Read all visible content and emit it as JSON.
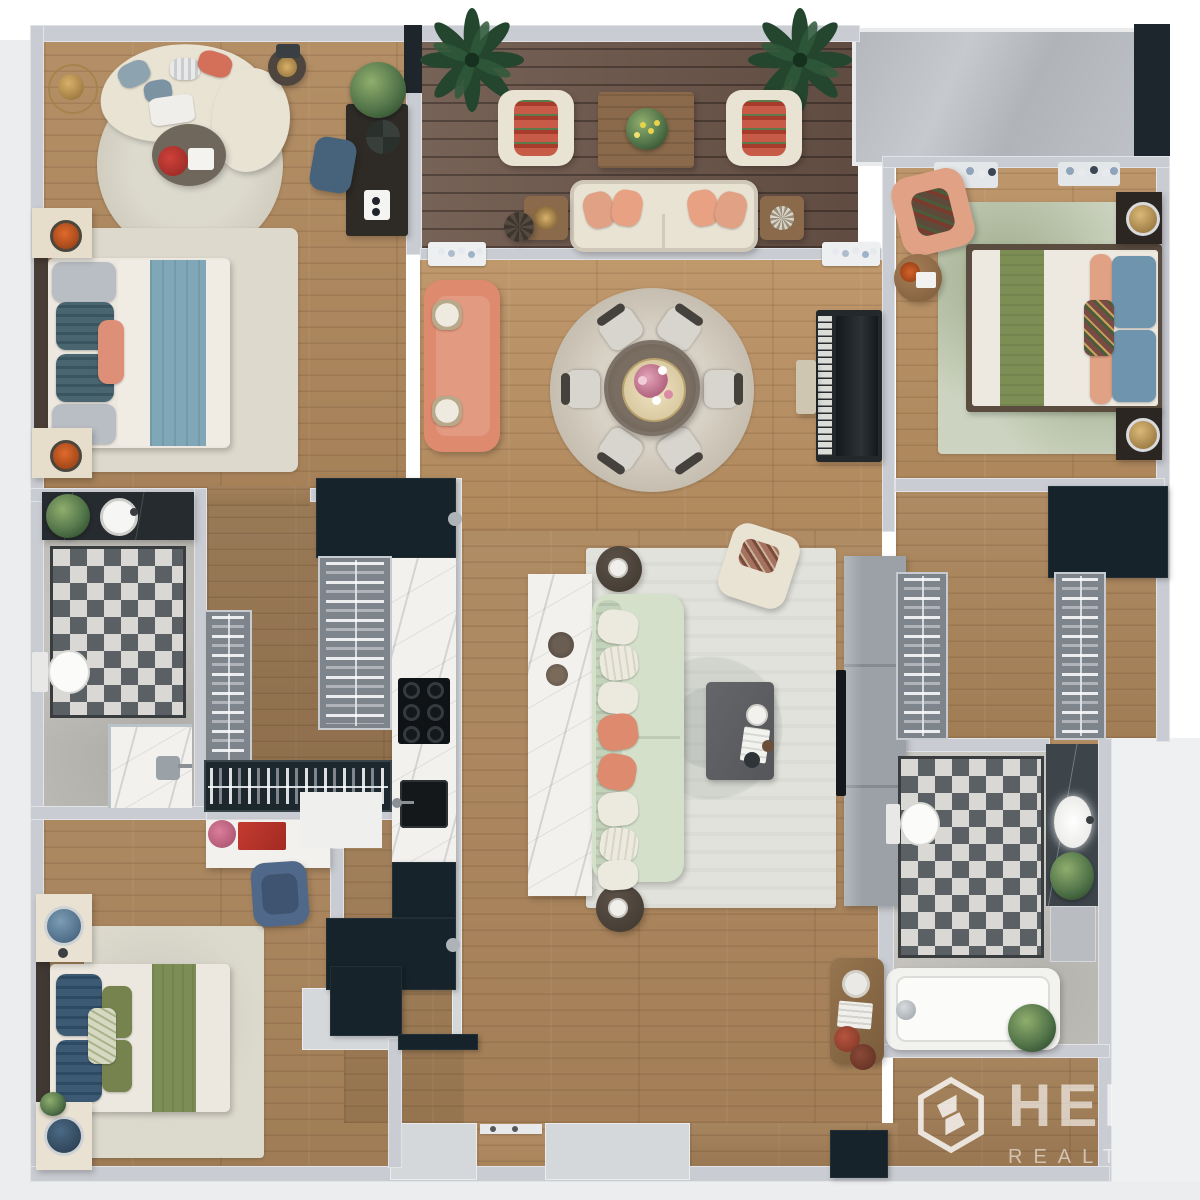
{
  "meta": {
    "description": "Top-down 3D rendered apartment floor plan (3 bedrooms, 2 bathrooms, open living-dining, galley kitchen, balcony terrace)",
    "canvas": {
      "width": 1200,
      "height": 1200
    }
  },
  "watermark": {
    "logo": "hexagon-monogram",
    "line1": "HER",
    "line2": "REALT",
    "note": "semi-transparent white watermark clipped at right edge of plan"
  },
  "palette": {
    "wall": "#c9ccd2",
    "outer": "#ecedef",
    "outerRight": "#eef0f2",
    "wood": "#b0895e",
    "deck": "#6d564a",
    "stone": "#bcbab4",
    "marble": "#f2f1ee",
    "marbleDark": "#262b2f",
    "cabinet": "#16232a",
    "tileDark": "#5b6064",
    "tileLight": "#d9d8d4",
    "sage": "#d4e0ca",
    "coral": "#dd8a6e",
    "cream": "#e9e3d4",
    "peach": "#e0a184",
    "navy": "#3d5a74",
    "greenRunner": "#7d8e55",
    "blueBlanket": "#7fa7b8",
    "rugLight": "#e2e2dc",
    "rugGreen": "#ccd3c0",
    "grey": "#9ba1a7",
    "glass": "#bcbfc4",
    "darkFrame": "#1d262c",
    "gold": "#c9a15a",
    "orange": "#e06a2d"
  },
  "rooms": [
    {
      "id": "master-bedroom",
      "name": "Master Bedroom",
      "position": "top-left",
      "furniture": [
        "double-bed-blue-throw",
        "nightstands-with-candles",
        "curved-chaise-sofa",
        "round-rug",
        "coffee-table-red-flowers",
        "gold-floor-lamp",
        "desk-with-plant",
        "blue-office-chair"
      ]
    },
    {
      "id": "balcony",
      "name": "Balcony Terrace",
      "position": "top-center",
      "furniture": [
        "outdoor-sofa-peach-pillows",
        "two-armchairs",
        "wood-coffee-table",
        "two-side-tables",
        "rattan-stool",
        "two-palm-plants"
      ]
    },
    {
      "id": "bedroom-2",
      "name": "Bedroom 2",
      "position": "top-right",
      "furniture": [
        "double-bed-green-runner",
        "dark-nightstands-gold-lamps",
        "peach-accent-armchair",
        "round-side-table",
        "green-area-rug",
        "wall-planters"
      ]
    },
    {
      "id": "dining-room",
      "name": "Dining Room",
      "position": "center",
      "furniture": [
        "round-dining-table",
        "six-chairs",
        "round-rug",
        "coral-sofa",
        "upright-piano",
        "piano-bench",
        "wall-planters"
      ]
    },
    {
      "id": "living-room",
      "name": "Living Room",
      "position": "center-bottom",
      "furniture": [
        "sage-sofa",
        "marble-console",
        "grey-coffee-table",
        "cream-armchair",
        "round-side-tables",
        "ornate-area-rug",
        "tv-wall-unit"
      ]
    },
    {
      "id": "kitchen",
      "name": "Kitchen",
      "position": "center-left",
      "furniture": [
        "marble-counter",
        "gas-cooktop",
        "black-sink",
        "dark-cabinets"
      ]
    },
    {
      "id": "walk-in-closet-1",
      "name": "Walk-in Closet",
      "position": "left",
      "furniture": [
        "hanging-racks"
      ]
    },
    {
      "id": "bathroom-1",
      "name": "Bathroom 1",
      "position": "left",
      "furniture": [
        "dark-vanity-round-sink",
        "toilet",
        "walk-in-shower",
        "checkerboard-floor",
        "plant"
      ]
    },
    {
      "id": "bedroom-3",
      "name": "Bedroom 3",
      "position": "bottom-left",
      "furniture": [
        "double-bed-green-runner",
        "cream-nightstands-blue-lamps",
        "white-desk-red-art",
        "blue-office-chair",
        "area-rug"
      ]
    },
    {
      "id": "walk-in-closet-2",
      "name": "Walk-in Closet 2",
      "position": "right",
      "furniture": [
        "hanging-racks",
        "dark-cabinet"
      ]
    },
    {
      "id": "bathroom-2",
      "name": "Bathroom 2",
      "position": "bottom-right",
      "furniture": [
        "bathtub",
        "toilet",
        "marble-vanity-oval-sink",
        "checkerboard-floor",
        "plants",
        "grey-cabinet"
      ]
    },
    {
      "id": "hallway",
      "name": "Hallway / Entry",
      "position": "bottom-center",
      "furniture": [
        "wood-console-table",
        "entry-door-recess",
        "dark-cabinet"
      ]
    }
  ]
}
